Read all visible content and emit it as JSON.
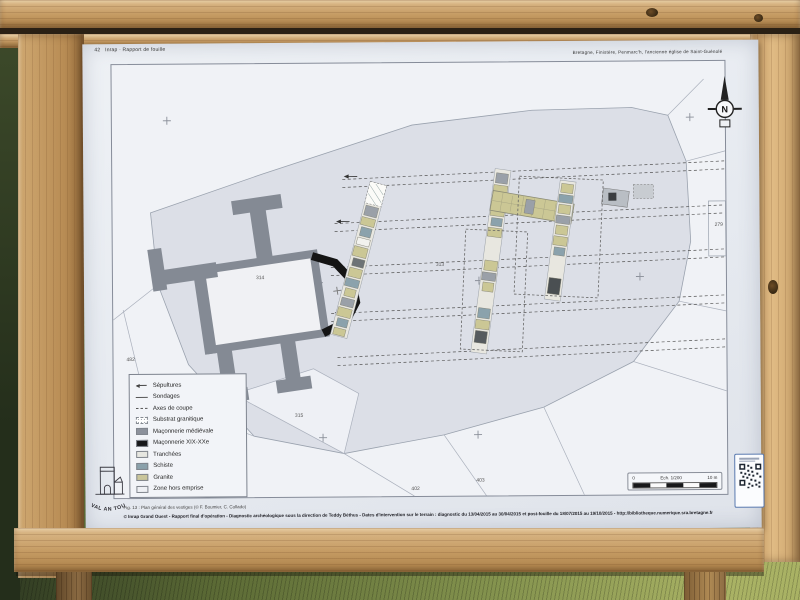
{
  "header": {
    "report_number": "42",
    "publication": "Inrap · Rapport de fouille",
    "location": "Bretagne, Finistère, Penmarc'h, l'ancienne église de Saint-Guénolé"
  },
  "map": {
    "north_label": "N",
    "parcels": [
      {
        "text": "314"
      },
      {
        "text": "313"
      },
      {
        "text": "279"
      },
      {
        "text": "315"
      },
      {
        "text": "482"
      },
      {
        "text": "402"
      },
      {
        "text": "403"
      }
    ]
  },
  "legend": {
    "items": [
      {
        "label": "Sépultures",
        "symbol": "burial-arrow"
      },
      {
        "label": "Sondages",
        "symbol": "line"
      },
      {
        "label": "Axes de coupe",
        "symbol": "dashed-line"
      },
      {
        "label": "Substrat granitique",
        "symbol": "hatched-box"
      },
      {
        "label": "Maçonnerie médiévale",
        "color": "#8c919b"
      },
      {
        "label": "Maçonnerie XIX-XXe",
        "color": "#17181a"
      },
      {
        "label": "Tranchées",
        "color": "#e6e6e0"
      },
      {
        "label": "Schiste",
        "color": "#8aa1ab"
      },
      {
        "label": "Granite",
        "color": "#c9c59a"
      },
      {
        "label": "Zone hors emprise",
        "color": "#eef0f4"
      }
    ]
  },
  "scalebar": {
    "start": "0",
    "ratio": "Ech. 1/200",
    "end": "10 m"
  },
  "caption": {
    "figure": "Fig. 13 : Plan général des vestiges (© F. Boumier, C. Collado)",
    "credit": "© Inrap Grand Ouest - Rapport final d'opération - Diagnostic archéologique sous la direction de Teddy Béthus - Dates d'intervention sur le terrain : diagnostic du 13/04/2015 au 30/04/2015 et post-fouille du 18/07/2015 au 19/10/2015 - http://bibliotheque.numerique.sra.bretagne.fr"
  },
  "logo": {
    "text": "VAL AN TOUR"
  },
  "colors": {
    "paper": "#e9edf3",
    "wood": "#c49a62",
    "grass": "#6a7a3f",
    "masonry_medieval": "#8c919b",
    "masonry_modern": "#17181a",
    "schiste": "#8aa1ab",
    "granite": "#c9c59a",
    "emprise": "#dcdfe7"
  }
}
